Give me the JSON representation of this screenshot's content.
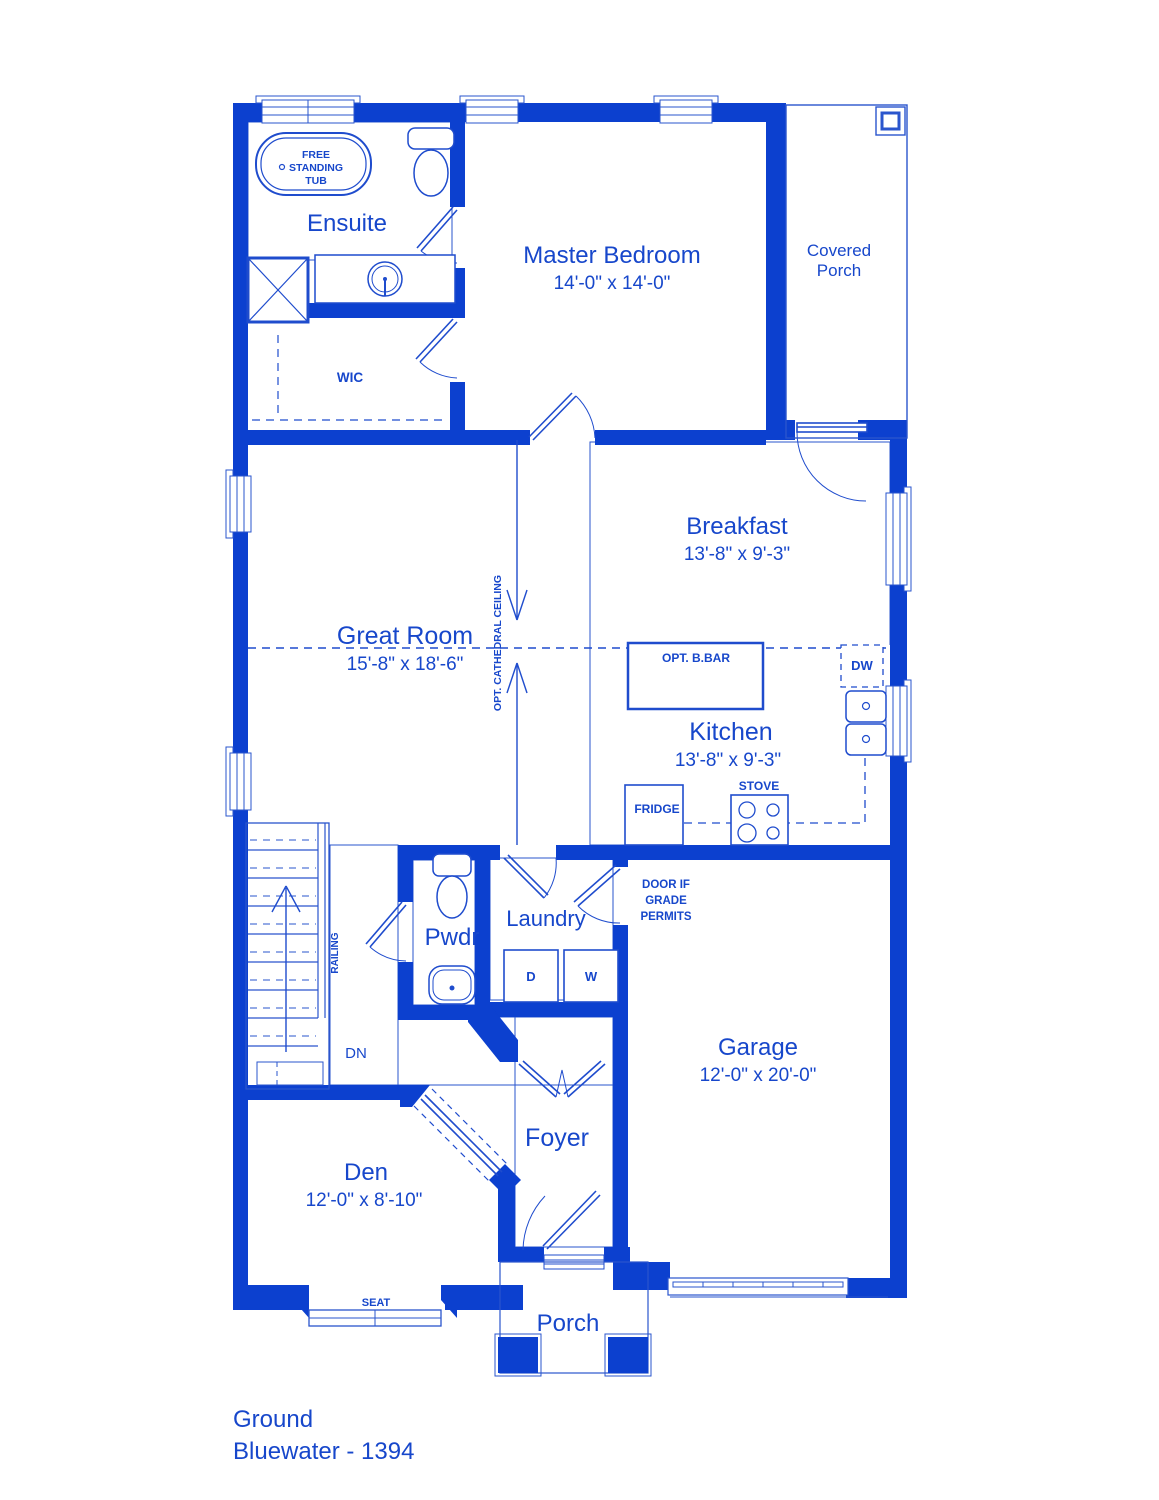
{
  "title": "Bluewater floor plan - ground level",
  "colors": {
    "wall_blue": "#0c40cf",
    "line_blue": "#2a55cd",
    "tile_blue": "#3f64d3",
    "text_blue": "#1747cb",
    "background": "#ffffff"
  },
  "rooms": {
    "ensuite": {
      "name": "Ensuite"
    },
    "wic": {
      "name": "WIC"
    },
    "master_bedroom": {
      "name": "Master Bedroom",
      "dims": "14'-0\" x 14'-0\""
    },
    "covered_porch": {
      "line1": "Covered",
      "line2": "Porch"
    },
    "great_room": {
      "name": "Great Room",
      "dims": "15'-8\" x 18'-6\""
    },
    "breakfast": {
      "name": "Breakfast",
      "dims": "13'-8\" x 9'-3\""
    },
    "kitchen": {
      "name": "Kitchen",
      "dims": "13'-8\" x 9'-3\""
    },
    "pwdr": {
      "name": "Pwdr"
    },
    "laundry": {
      "name": "Laundry"
    },
    "garage": {
      "name": "Garage",
      "dims": "12'-0\" x 20'-0\""
    },
    "den": {
      "name": "Den",
      "dims": "12'-0\" x 8'-10\""
    },
    "foyer": {
      "name": "Foyer"
    },
    "porch": {
      "name": "Porch"
    }
  },
  "fixtures": {
    "tub": {
      "line1": "FREE",
      "line2": "STANDING",
      "line3": "TUB"
    },
    "island_label": "OPT. B.BAR",
    "dishwasher_label": "DW",
    "fridge_label": "FRIDGE",
    "stove_label": "STOVE",
    "dryer_label": "D",
    "washer_label": "W",
    "seat_label": "SEAT"
  },
  "annotations": {
    "cathedral_ceiling": "OPT. CATHEDRAL CEILING",
    "railing": "RAILING",
    "down": "DN",
    "grade_door": {
      "line1": "DOOR IF",
      "line2": "GRADE",
      "line3": "PERMITS"
    }
  },
  "footer": {
    "level": "Ground",
    "plan_name": "Bluewater - 1394"
  }
}
